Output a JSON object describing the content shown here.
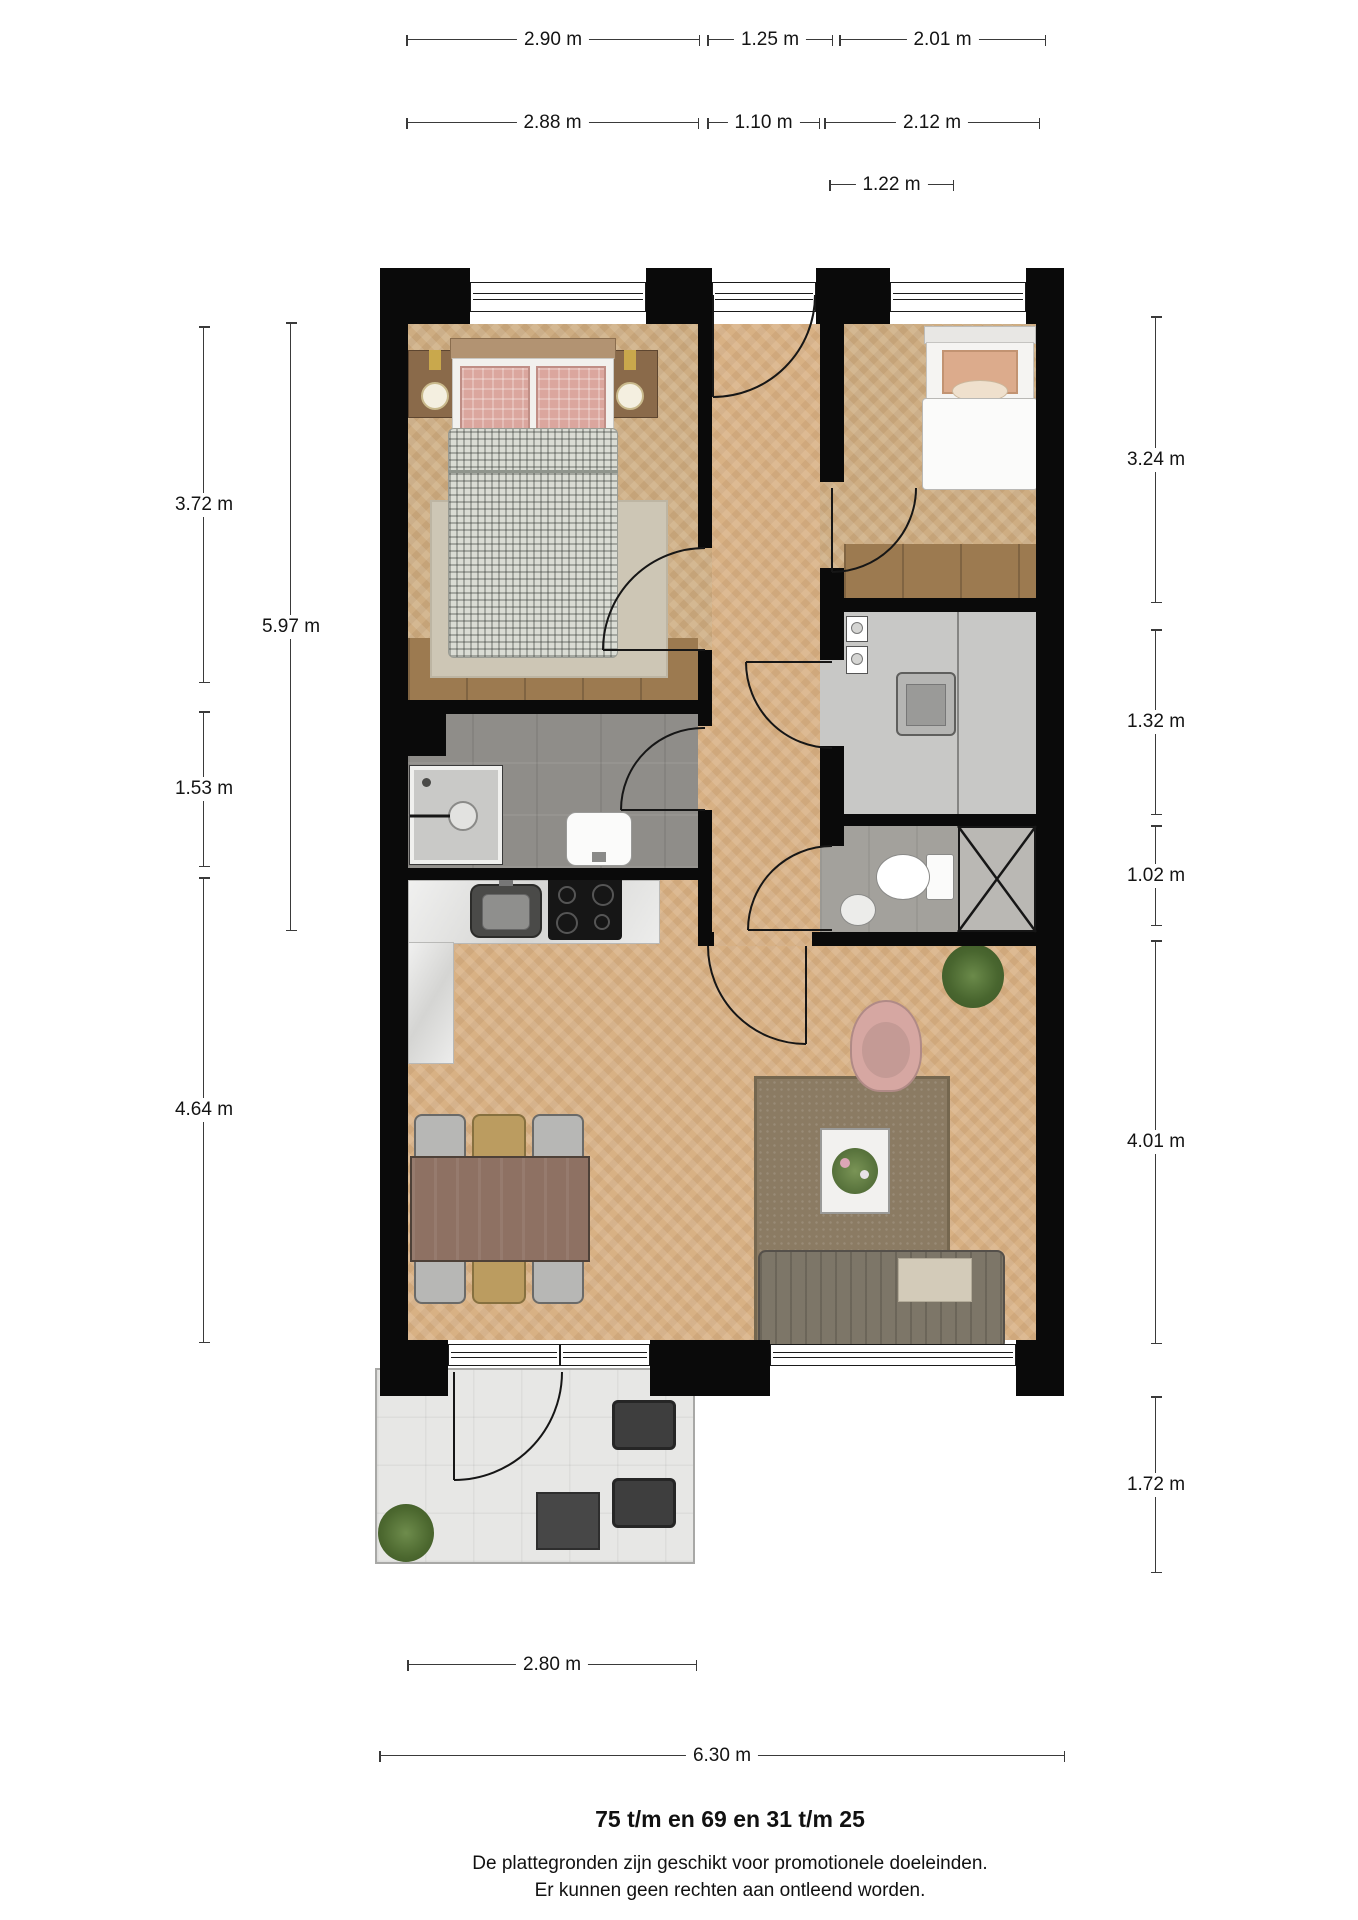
{
  "dimensions": {
    "top_row1": [
      "2.90 m",
      "1.25 m",
      "2.01 m"
    ],
    "top_row2": [
      "2.88 m",
      "1.10 m",
      "2.12 m"
    ],
    "top_row3": [
      "1.22 m"
    ],
    "left": [
      "3.72 m",
      "5.97 m",
      "1.53 m",
      "4.64 m"
    ],
    "right": [
      "3.24 m",
      "1.32 m",
      "1.02 m",
      "4.01 m",
      "1.72 m"
    ],
    "bottom": [
      "2.80 m",
      "6.30 m"
    ]
  },
  "footer": {
    "title": "75 t/m en 69 en 31 t/m 25",
    "disclaimer_line1": "De plattegronden zijn geschikt voor promotionele doeleinden.",
    "disclaimer_line2": "Er kunnen geen rechten aan ontleend worden."
  },
  "colors": {
    "wall": "#0a0a0a",
    "wood_light": "#d8b184",
    "wood_dark": "#9c7a50",
    "tile_gray": "#8f8d89",
    "terrace": "#e7e7e5",
    "dimension_text": "#141414"
  }
}
